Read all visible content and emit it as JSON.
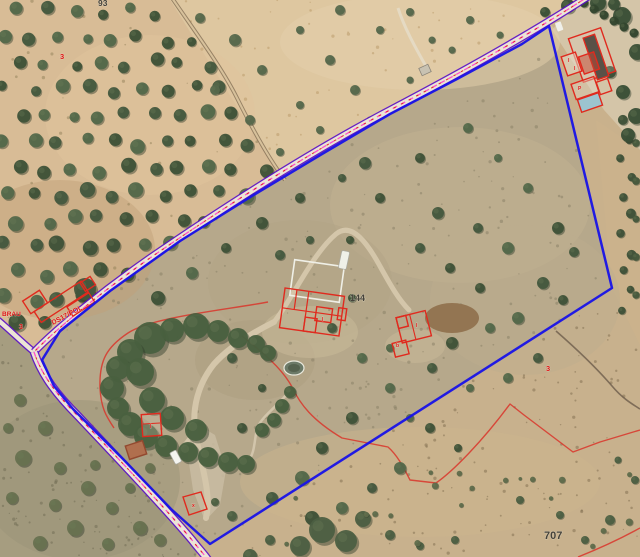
{
  "view": {
    "type": "aerial-cadastral-map",
    "width": 640,
    "height": 557,
    "description": "orthophoto with cadastral parcel overlay"
  },
  "colors": {
    "parcel_boundary": "#1a14e6",
    "road_edge": "#5a10c8",
    "road_surface": "#ece5d6",
    "road_dash_pink": "#ff52c8",
    "road_dash_red": "#e02020",
    "building_outline": "#e02a1e",
    "subparcel_line": "#d9352a",
    "label_dark": "#45423a",
    "label_red": "#e01414",
    "pool": "#9cc4cf"
  },
  "labels": {
    "parcel_numbers": [
      {
        "text": "144",
        "x": 350,
        "y": 301,
        "size": 9
      },
      {
        "text": "707",
        "x": 544,
        "y": 539,
        "size": 11
      },
      {
        "text": "93",
        "x": 98,
        "y": 6,
        "size": 8.5
      }
    ],
    "street_labels": [
      {
        "text": "BRAU",
        "x": 2,
        "y": 316,
        "rotate": 0,
        "size": 6.5
      },
      {
        "text": "3",
        "x": 19,
        "y": 329,
        "rotate": 0,
        "size": 7
      },
      {
        "text": "DS17/POL",
        "x": 53,
        "y": 325,
        "rotate": -28,
        "size": 7
      },
      {
        "text": "3",
        "x": 60,
        "y": 59,
        "rotate": 0,
        "size": 7.5
      },
      {
        "text": "3",
        "x": 546,
        "y": 371,
        "rotate": 0,
        "size": 7.5
      }
    ],
    "building_marks": [
      {
        "text": "I",
        "x": 568,
        "y": 62
      },
      {
        "text": "I",
        "x": 574,
        "y": 70
      },
      {
        "text": "P",
        "x": 578,
        "y": 90
      },
      {
        "text": "I",
        "x": 322,
        "y": 321
      },
      {
        "text": "I",
        "x": 416,
        "y": 327
      },
      {
        "text": "b",
        "x": 396,
        "y": 347
      },
      {
        "text": "I",
        "x": 150,
        "y": 428
      },
      {
        "text": "x",
        "x": 192,
        "y": 507
      }
    ]
  }
}
